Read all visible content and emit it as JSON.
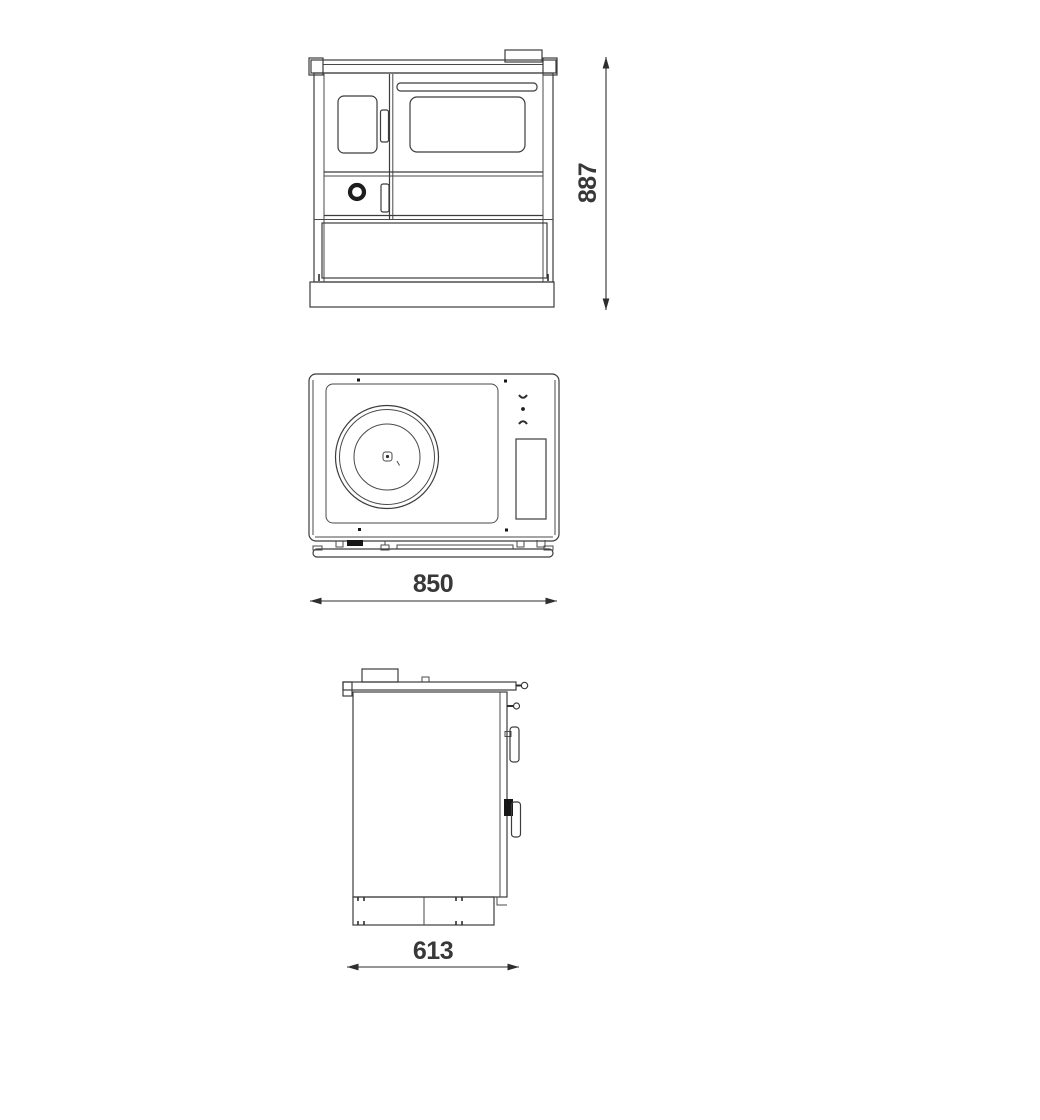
{
  "canvas": {
    "background": "#ffffff",
    "line_color": "#3c3c3c",
    "dimension_text_color": "#383838"
  },
  "views": {
    "front": {
      "dimension_label": "887"
    },
    "top": {
      "dimension_label": "850"
    },
    "side": {
      "dimension_label": "613"
    }
  }
}
